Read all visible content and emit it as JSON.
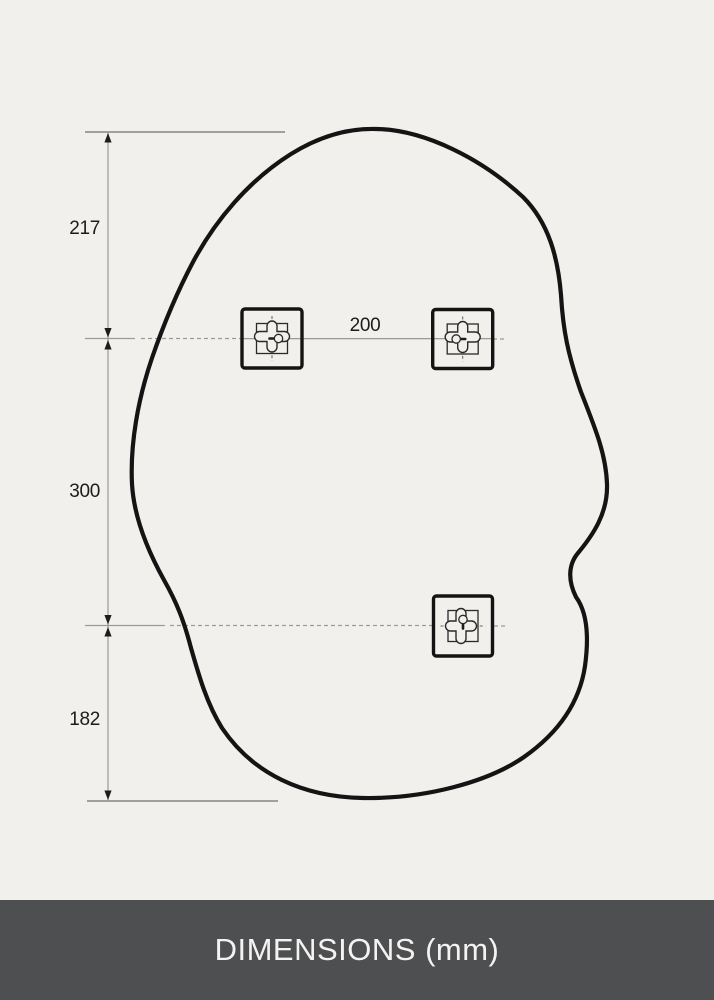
{
  "footer": {
    "title": "DIMENSIONS (mm)"
  },
  "dimensions": {
    "unit": "mm",
    "top_to_upper_hangers": "217",
    "upper_to_lower_hanger": "300",
    "lower_hanger_to_bottom": "182",
    "hanger_spacing": "200"
  },
  "icons": {
    "wall_bracket": "keyhole-mount-bracket-icon"
  },
  "colors": {
    "background": "#f1f0ed",
    "mirror_outline": "#141414",
    "dimension_line": "#9a9a9a",
    "extension_line": "#6f6f6f",
    "label_text": "#1c1c1c",
    "footer_background": "#4e4f51",
    "footer_text": "#f4f3f1"
  }
}
